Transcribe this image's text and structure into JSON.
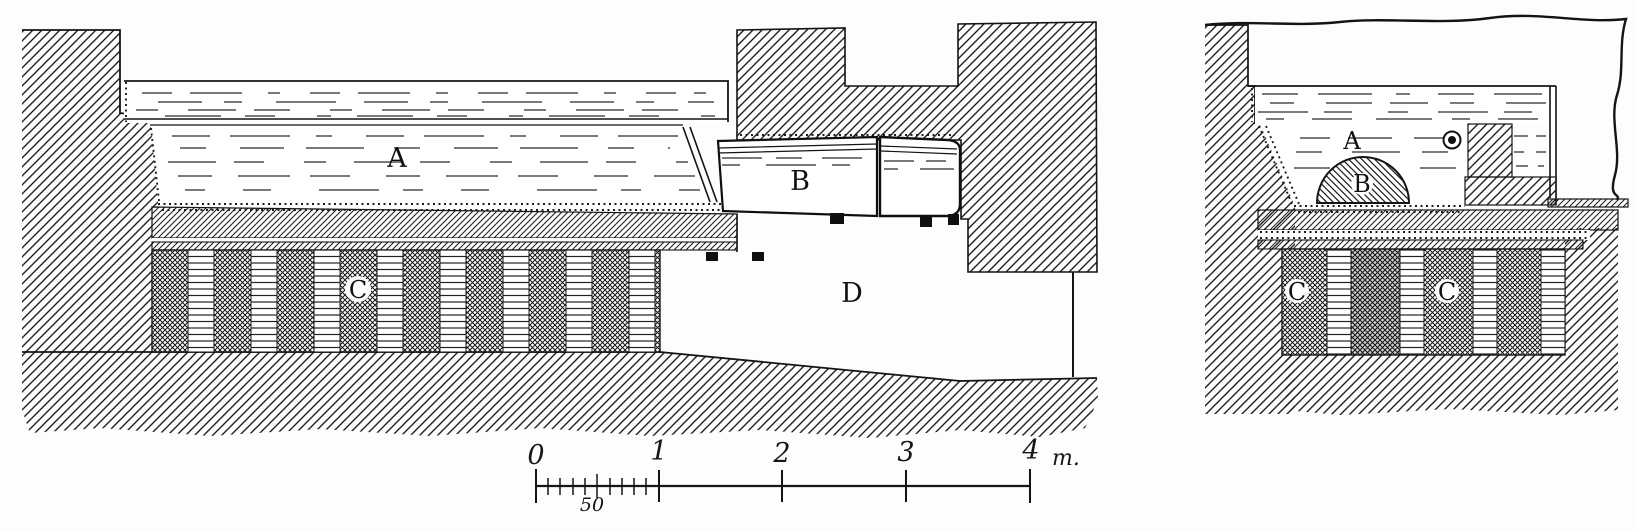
{
  "left_figure": {
    "label_a": "A",
    "label_b": "B",
    "label_c": "C",
    "label_d": "D"
  },
  "right_figure": {
    "label_a": "A",
    "label_b": "B",
    "label_c_left": "C",
    "label_c_right": "C"
  },
  "scale_bar": {
    "major_ticks": [
      "0",
      "1",
      "2",
      "3",
      "4"
    ],
    "unit_label": "m.",
    "half_meter_label": "50"
  },
  "colors": {
    "ink": "#1a1a1a",
    "paper": "#fdfdfc"
  }
}
